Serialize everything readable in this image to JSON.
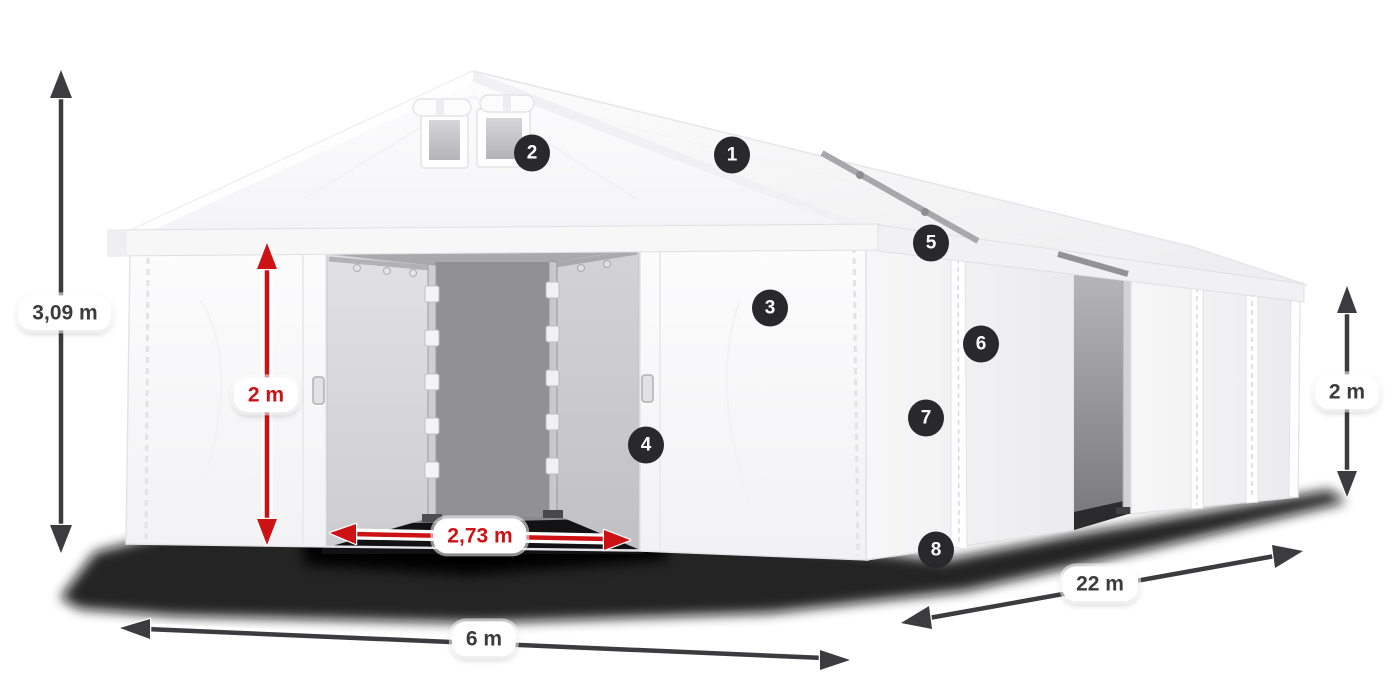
{
  "diagram": {
    "type": "product-dimension-diagram",
    "subject": "white storage marquee tent with open double door, shown in perspective",
    "measurements": {
      "total_height": {
        "label": "3,09 m"
      },
      "door_height": {
        "label": "2 m"
      },
      "door_width": {
        "label": "2,73 m"
      },
      "width": {
        "label": "6 m"
      },
      "length": {
        "label": "22 m"
      },
      "side_wall_height": {
        "label": "2 m"
      }
    },
    "markers": [
      {
        "label": "1"
      },
      {
        "label": "2"
      },
      {
        "label": "3"
      },
      {
        "label": "4"
      },
      {
        "label": "5"
      },
      {
        "label": "6"
      },
      {
        "label": "7"
      },
      {
        "label": "8"
      }
    ],
    "colors": {
      "accent_red": "#cd1216",
      "dimension_dark": "#3c3c3e",
      "marker_background": "#29292b",
      "marker_text": "#ffffff",
      "tent_white": "#fbfbfc",
      "interior_gray": "#9a9a9c",
      "shadow_black": "#0a0a0a"
    }
  }
}
